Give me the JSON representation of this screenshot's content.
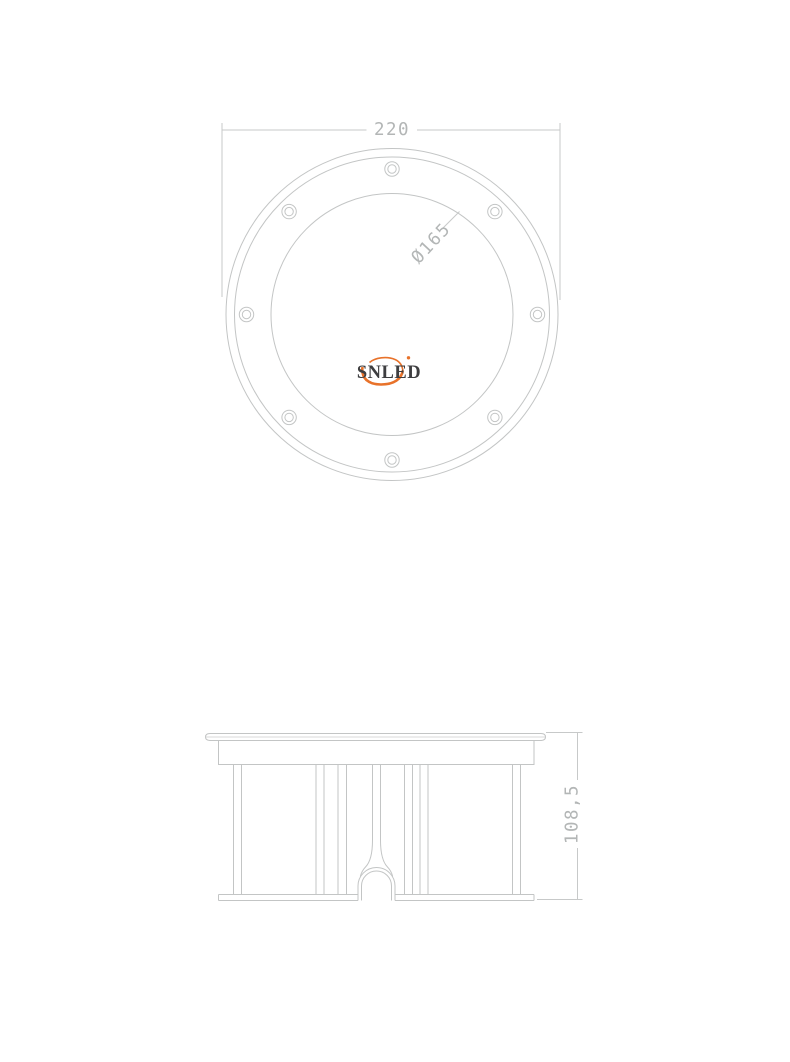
{
  "top_view": {
    "outer_diameter_dim": "220",
    "lens_diameter_label": "Ø165",
    "screw_hole_count": 8,
    "logo_text": "SNLED"
  },
  "side_view": {
    "height_dim": "108,5"
  },
  "colors": {
    "background": "#ffffff",
    "drawing_lines": "#c3c5c5",
    "dimension_text": "#b3b6b6",
    "logo_text": "#3e3e40",
    "logo_swoosh": "#e8722a"
  }
}
